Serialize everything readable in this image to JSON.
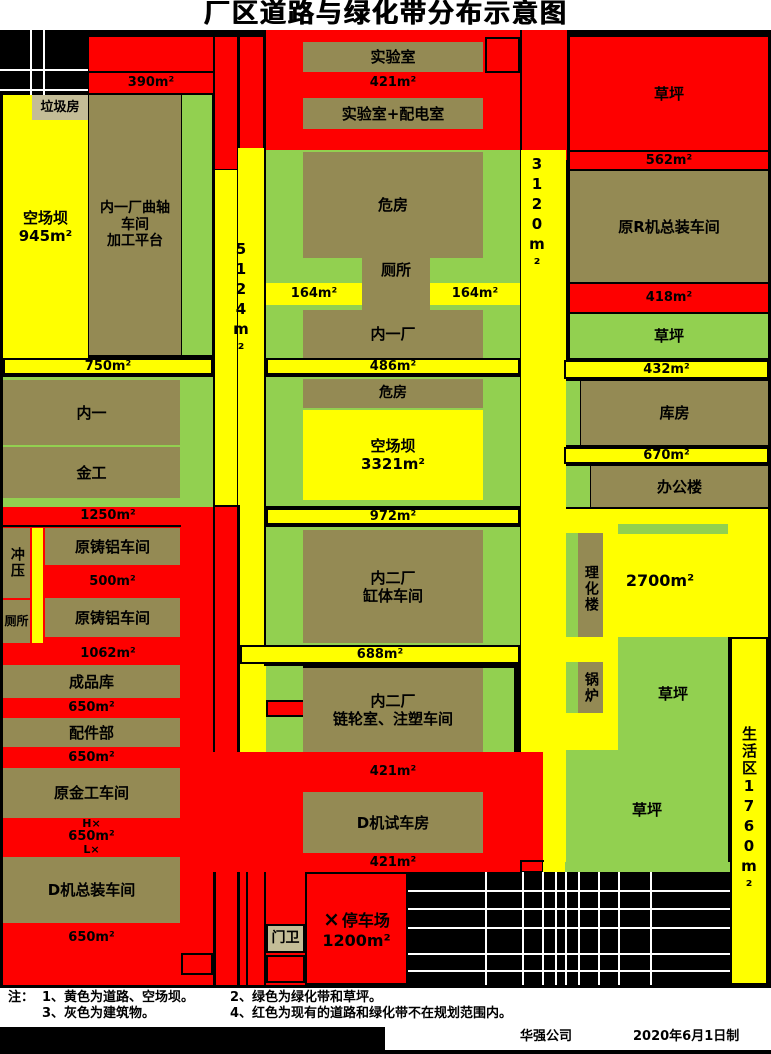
{
  "title": "厂区道路与绿化带分布示意图",
  "colors": {
    "road_yellow": "#ffff00",
    "greenbelt_green": "#92d050",
    "building_olive": "#948a54",
    "red_area": "#fe0000",
    "small_building_tan": "#c4bd97"
  },
  "top": {
    "laji": "垃圾房",
    "kcb_name": "空场坝",
    "kcb_area": "945m²",
    "quzhou1": "内一厂曲轴",
    "quzhou2": "车间",
    "quzhou3": "加工平台",
    "a390": "390m²"
  },
  "roads": {
    "a5124": "5124m²",
    "a3120": "3120m²"
  },
  "lab": {
    "shiyanshi": "实验室",
    "a421": "421m²",
    "peidian": "实验室+配电室"
  },
  "hzone": {
    "weifang": "危房",
    "cesuo": "厕所",
    "a164l": "164m²",
    "a164r": "164m²",
    "neiyichang": "内一厂"
  },
  "strips": {
    "a750": "750m²",
    "a486": "486m²",
    "a432": "432m²",
    "a1250": "1250m²",
    "a972": "972m²",
    "a688": "688m²",
    "a670": "670m²"
  },
  "left": {
    "neiyi": "内一",
    "jingong": "金工",
    "chongya": "冲压",
    "cesuo": "厕所",
    "zhulv1": "原铸铝车间",
    "a500": "500m²",
    "zhulv2": "原铸铝车间",
    "a1062": "1062m²",
    "chengpinku": "成品库",
    "a650a": "650m²",
    "peijianbu": "配件部",
    "a650b": "650m²",
    "yuanjingong": "原金工车间",
    "hx": "H×",
    "a650c": "650m²",
    "lx": "L×",
    "djizongzhuang": "D机总装车间",
    "a650d": "650m²"
  },
  "mid": {
    "weifang2": "危房",
    "kcb2_name": "空场坝",
    "kcb2_area": "3321m²",
    "neier1": "内二厂",
    "gangti": "缸体车间",
    "neier2": "内二厂",
    "lianlun": "链轮室、注塑车间",
    "a421b": "421m²",
    "djishiche": "D机试车房",
    "a421c": "421m²"
  },
  "right": {
    "caoping_top": "草坪",
    "a562": "562m²",
    "yuanrji": "原R机总装车间",
    "a418": "418m²",
    "caoping2": "草坪",
    "kufang": "库房",
    "bangonglou": "办公楼",
    "lihualou": "理化楼",
    "a2700": "2700m²",
    "guolu": "锅炉",
    "caoping3": "草坪",
    "caoping4": "草坪",
    "shenghuoqu": "生活区1760m²"
  },
  "bottom": {
    "menwei": "门卫",
    "parking_mark": "×",
    "parking_name": "停车场",
    "parking_area": "1200m²"
  },
  "notes": {
    "prefix": "注：",
    "n1": "1、黄色为道路、空场坝。",
    "n2": "2、绿色为绿化带和草坪。",
    "n3": "3、灰色为建筑物。",
    "n4": "4、红色为现有的道路和绿化带不在规划范围内。"
  },
  "footer": {
    "company": "华强公司",
    "date": "2020年6月1日制"
  }
}
